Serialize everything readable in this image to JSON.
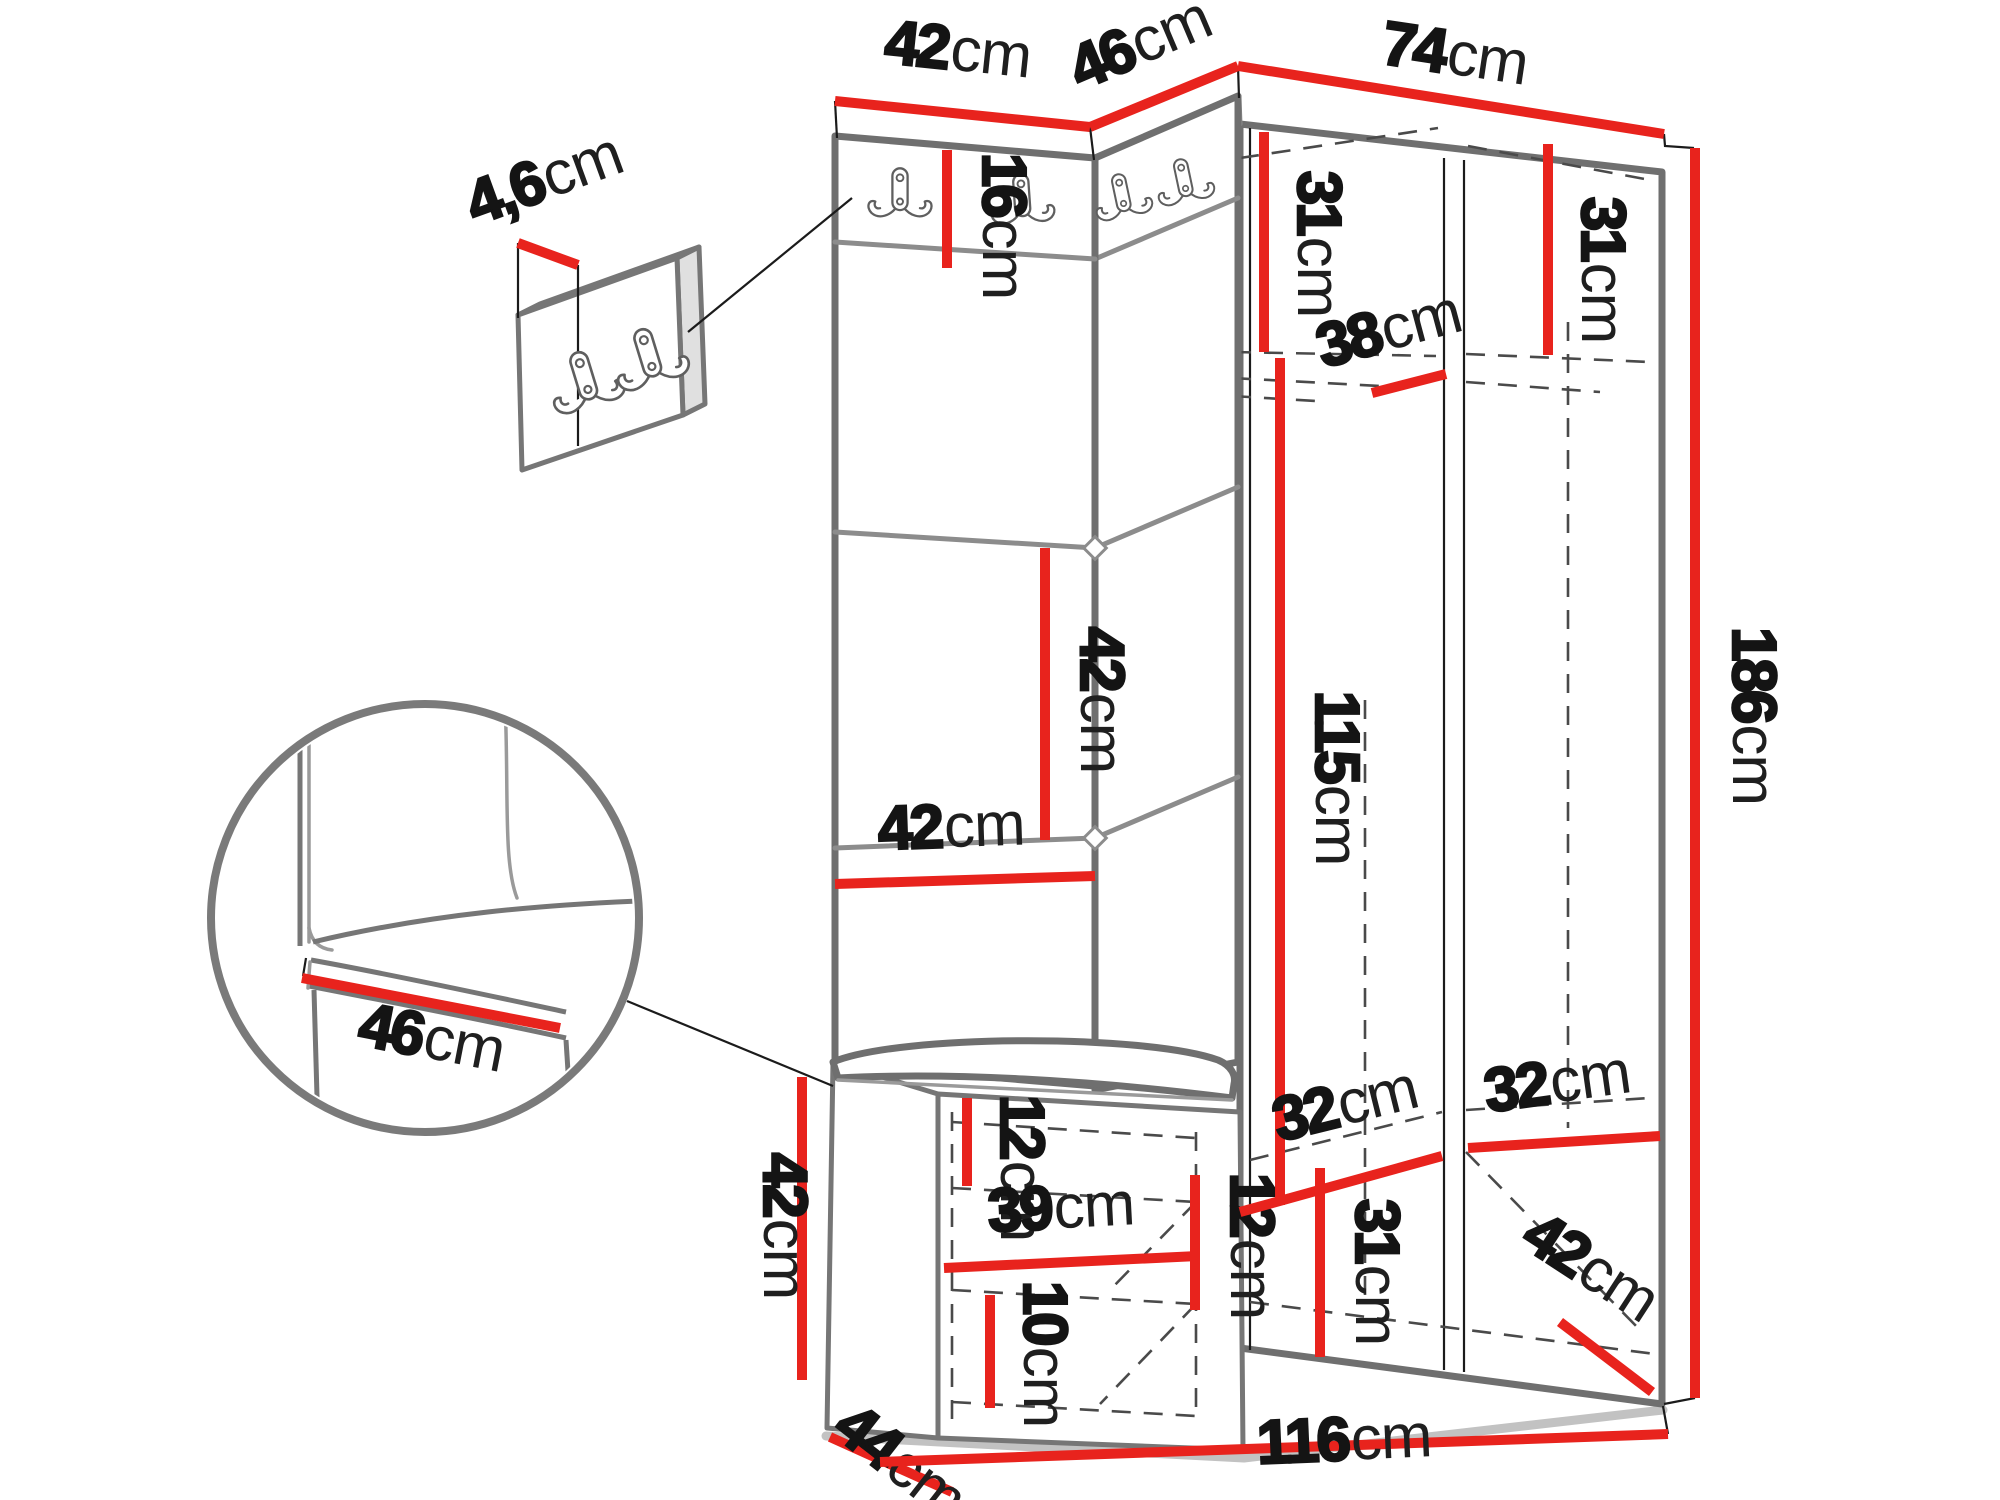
{
  "page": {
    "background_color": "#ffffff",
    "kind": "furniture-dimension-diagram"
  },
  "colors": {
    "dimension_line": "#e8231d",
    "dimension_text": "#141414",
    "unit_text": "#1f1f1f",
    "outline": "#6f6f6f"
  },
  "unit_default": "cm",
  "dimensions": [
    {
      "name": "panel-top-width-42",
      "value": "42",
      "unit": "cm",
      "line": {
        "x1": 835,
        "y1": 101,
        "x2": 1090,
        "y2": 127
      },
      "label": {
        "x": 956,
        "y": 70,
        "rot": 6,
        "size": 62
      }
    },
    {
      "name": "corner-top-depth-46",
      "value": "46",
      "unit": "cm",
      "line": {
        "x1": 1090,
        "y1": 127,
        "x2": 1238,
        "y2": 66
      },
      "label": {
        "x": 1148,
        "y": 62,
        "rot": -23,
        "size": 62
      }
    },
    {
      "name": "wardrobe-top-width-74",
      "value": "74",
      "unit": "cm",
      "line": {
        "x1": 1238,
        "y1": 66,
        "x2": 1664,
        "y2": 134
      },
      "label": {
        "x": 1452,
        "y": 74,
        "rot": 8.5,
        "size": 62
      }
    },
    {
      "name": "hook-strip-height-16",
      "value": "16",
      "unit": "cm",
      "line": {
        "x1": 947,
        "y1": 150,
        "x2": 947,
        "y2": 268
      },
      "label": {
        "x": 983,
        "y": 226,
        "rot": 90,
        "size": 62
      }
    },
    {
      "name": "top-shelf-height-31-left",
      "value": "31",
      "unit": "cm",
      "line": {
        "x1": 1264,
        "y1": 132,
        "x2": 1264,
        "y2": 352
      },
      "label": {
        "x": 1298,
        "y": 244,
        "rot": 90,
        "size": 62
      }
    },
    {
      "name": "top-shelf-height-31-right",
      "value": "31",
      "unit": "cm",
      "line": {
        "x1": 1548,
        "y1": 144,
        "x2": 1548,
        "y2": 355
      },
      "label": {
        "x": 1582,
        "y": 270,
        "rot": 90,
        "size": 62
      }
    },
    {
      "name": "shelf-depth-38",
      "value": "38",
      "unit": "cm",
      "line": {
        "x1": 1372,
        "y1": 393,
        "x2": 1446,
        "y2": 374
      },
      "label": {
        "x": 1394,
        "y": 349,
        "rot": -15,
        "size": 62
      }
    },
    {
      "name": "panel-square-42-vertical",
      "value": "42",
      "unit": "cm",
      "line": {
        "x1": 1045,
        "y1": 548,
        "x2": 1045,
        "y2": 840
      },
      "label": {
        "x": 1081,
        "y": 700,
        "rot": 90,
        "size": 62
      }
    },
    {
      "name": "panel-square-42-horizontal",
      "value": "42",
      "unit": "cm",
      "line": {
        "x1": 835,
        "y1": 884,
        "x2": 1095,
        "y2": 876
      },
      "label": {
        "x": 952,
        "y": 847,
        "rot": -2,
        "size": 62
      }
    },
    {
      "name": "door-height-115",
      "value": "115",
      "unit": "cm",
      "line": {
        "x1": 1280,
        "y1": 358,
        "x2": 1280,
        "y2": 1205
      },
      "label": {
        "x": 1316,
        "y": 778,
        "rot": 90,
        "size": 62
      }
    },
    {
      "name": "total-height-186",
      "value": "186",
      "unit": "cm",
      "line": {
        "x1": 1695,
        "y1": 148,
        "x2": 1695,
        "y2": 1398
      },
      "label": {
        "x": 1733,
        "y": 716,
        "rot": 90,
        "size": 62
      }
    },
    {
      "name": "seat-width-46-detail",
      "value": "46",
      "unit": "cm",
      "line": {
        "x1": 302,
        "y1": 978,
        "x2": 560,
        "y2": 1028
      },
      "label": {
        "x": 428,
        "y": 1058,
        "rot": 11,
        "size": 62
      }
    },
    {
      "name": "hook-panel-thickness-4-6",
      "value": "4,6",
      "unit": "cm",
      "line": {
        "x1": 518,
        "y1": 243,
        "x2": 578,
        "y2": 265
      },
      "label": {
        "x": 551,
        "y": 198,
        "rot": -20,
        "size": 56
      }
    },
    {
      "name": "bench-height-42",
      "value": "42",
      "unit": "cm",
      "line": {
        "x1": 802,
        "y1": 1077,
        "x2": 802,
        "y2": 1380
      },
      "label": {
        "x": 764,
        "y": 1226,
        "rot": 90,
        "size": 62
      }
    },
    {
      "name": "bench-depth-44",
      "value": "44",
      "unit": "cm",
      "line": {
        "x1": 830,
        "y1": 1437,
        "x2": 952,
        "y2": 1492
      },
      "label": {
        "x": 888,
        "y": 1478,
        "rot": 38,
        "size": 62
      }
    },
    {
      "name": "bench-inner-height-12-left",
      "value": "12",
      "unit": "cm",
      "line": {
        "x1": 967,
        "y1": 1098,
        "x2": 967,
        "y2": 1186
      },
      "label": {
        "x": 1001,
        "y": 1168,
        "rot": 90,
        "size": 62
      }
    },
    {
      "name": "bench-inner-width-39",
      "value": "39",
      "unit": "cm",
      "line": {
        "x1": 944,
        "y1": 1268,
        "x2": 1198,
        "y2": 1256
      },
      "label": {
        "x": 1062,
        "y": 1228,
        "rot": -3,
        "size": 62
      }
    },
    {
      "name": "bench-inner-height-12-right",
      "value": "12",
      "unit": "cm",
      "line": {
        "x1": 1195,
        "y1": 1175,
        "x2": 1195,
        "y2": 1310
      },
      "label": {
        "x": 1231,
        "y": 1246,
        "rot": 90,
        "size": 62
      }
    },
    {
      "name": "bench-bottom-height-10",
      "value": "10",
      "unit": "cm",
      "line": {
        "x1": 990,
        "y1": 1295,
        "x2": 990,
        "y2": 1408
      },
      "label": {
        "x": 1024,
        "y": 1354,
        "rot": 90,
        "size": 62
      }
    },
    {
      "name": "compartment-width-32-left",
      "value": "32",
      "unit": "cm",
      "line": {
        "x1": 1240,
        "y1": 1212,
        "x2": 1442,
        "y2": 1156
      },
      "label": {
        "x": 1350,
        "y": 1124,
        "rot": -14,
        "size": 62
      }
    },
    {
      "name": "compartment-width-32-right",
      "value": "32",
      "unit": "cm",
      "line": {
        "x1": 1468,
        "y1": 1148,
        "x2": 1660,
        "y2": 1136
      },
      "label": {
        "x": 1560,
        "y": 1102,
        "rot": -8,
        "size": 62
      }
    },
    {
      "name": "compartment-height-31",
      "value": "31",
      "unit": "cm",
      "line": {
        "x1": 1320,
        "y1": 1168,
        "x2": 1320,
        "y2": 1357
      },
      "label": {
        "x": 1356,
        "y": 1272,
        "rot": 90,
        "size": 62
      }
    },
    {
      "name": "compartment-depth-42",
      "value": "42",
      "unit": "cm",
      "line": {
        "x1": 1560,
        "y1": 1322,
        "x2": 1652,
        "y2": 1392
      },
      "label": {
        "x": 1580,
        "y": 1284,
        "rot": 33,
        "size": 62
      }
    },
    {
      "name": "total-width-116",
      "value": "116",
      "unit": "cm",
      "line": {
        "x1": 880,
        "y1": 1462,
        "x2": 1668,
        "y2": 1434
      },
      "label": {
        "x": 1345,
        "y": 1460,
        "rot": -2.5,
        "size": 62
      }
    }
  ],
  "hooks": {
    "icon": "double-coat-hook-icon",
    "positions": [
      {
        "name": "wardrobe-hook-1",
        "x": 900,
        "y": 193,
        "rot": 0,
        "scale": 0.95
      },
      {
        "name": "wardrobe-hook-2",
        "x": 1022,
        "y": 199,
        "rot": -4,
        "scale": 0.95
      },
      {
        "name": "wardrobe-hook-3",
        "x": 1122,
        "y": 196,
        "rot": -12,
        "scale": 0.85
      },
      {
        "name": "wardrobe-hook-4",
        "x": 1184,
        "y": 181,
        "rot": -12,
        "scale": 0.85
      },
      {
        "name": "detail-panel-hook-1",
        "x": 585,
        "y": 380,
        "rot": -17,
        "scale": 1.1
      },
      {
        "name": "detail-panel-hook-2",
        "x": 649,
        "y": 357,
        "rot": -17,
        "scale": 1.1
      }
    ]
  }
}
